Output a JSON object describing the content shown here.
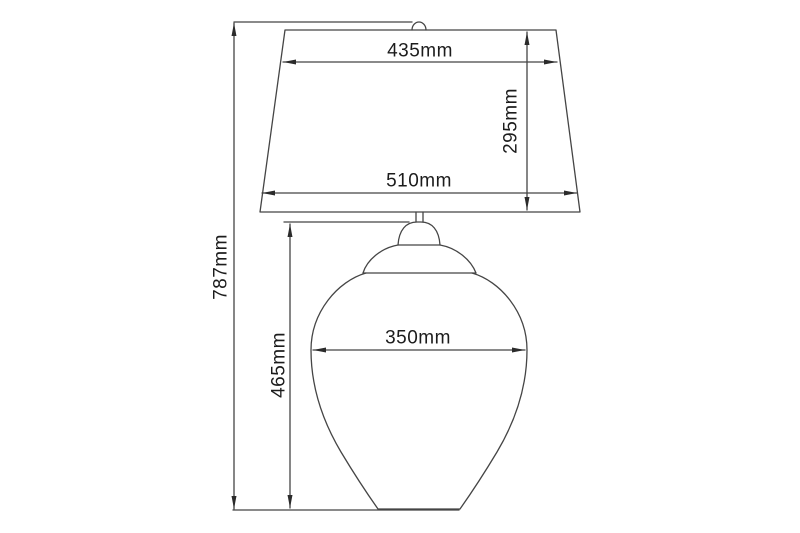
{
  "drawing": {
    "type": "technical-dimension-drawing",
    "subject": "table lamp with trapezoidal shade and urn-shaped glass body",
    "labels": {
      "shade_top_width": "435mm",
      "shade_height": "295mm",
      "shade_bottom_width": "510mm",
      "total_height": "787mm",
      "body_height": "465mm",
      "body_width": "350mm"
    },
    "colors": {
      "line": "#454545",
      "text": "#1c1c1c",
      "background": "#ffffff"
    }
  }
}
